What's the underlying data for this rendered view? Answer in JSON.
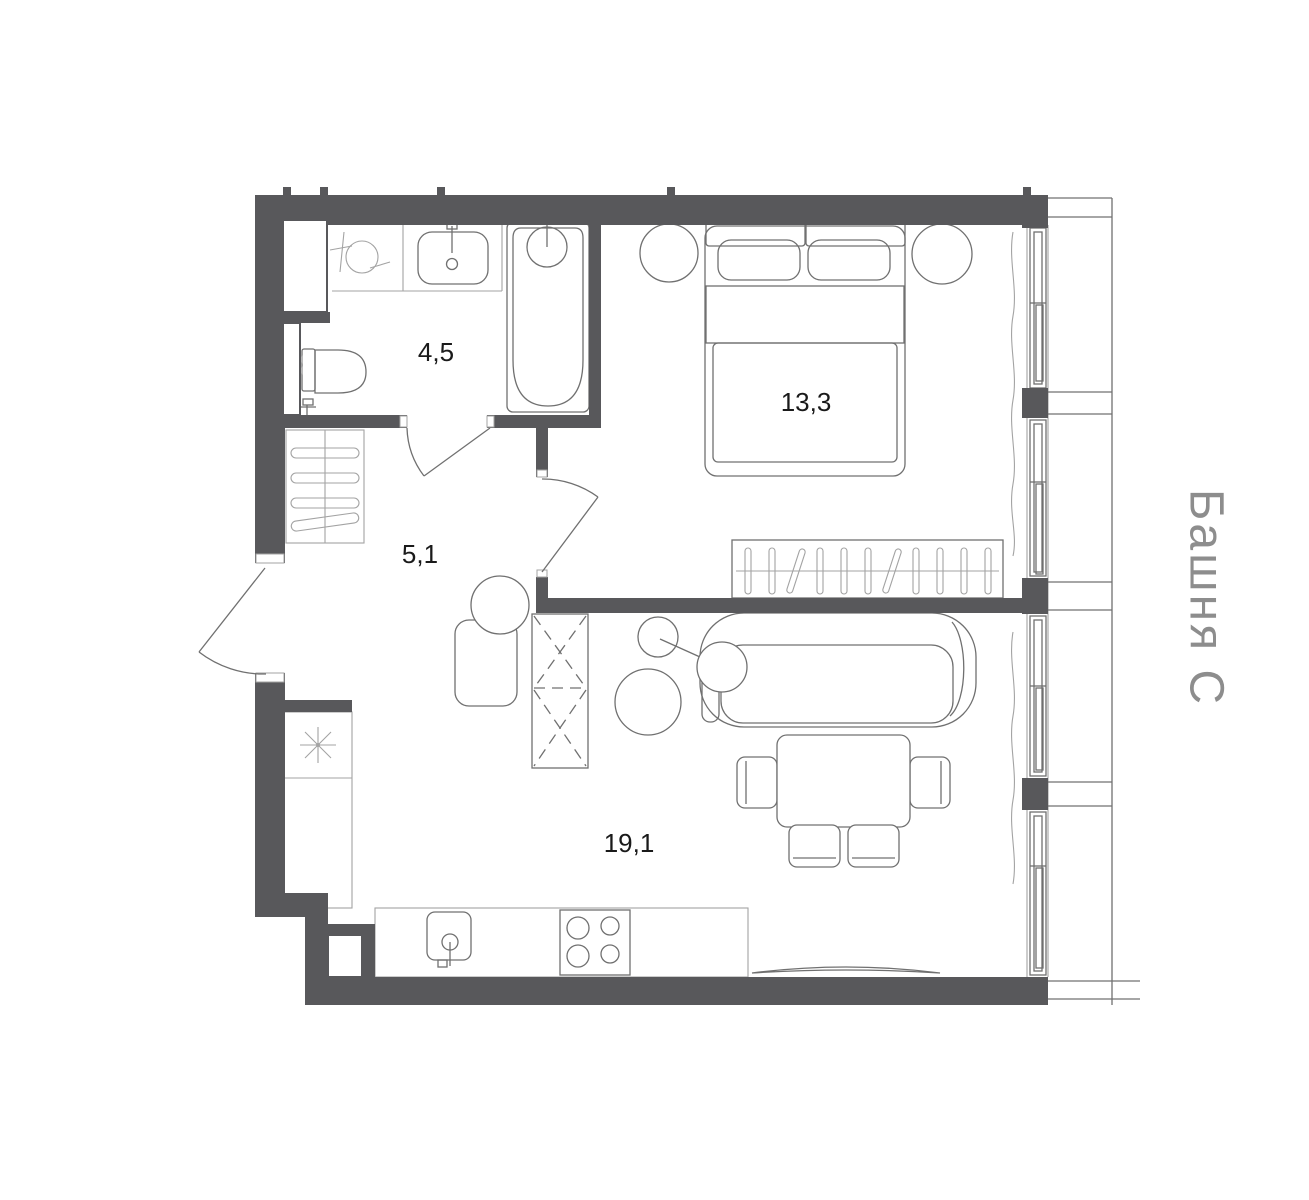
{
  "floorplan": {
    "tower_label": "Башня С",
    "rooms": [
      {
        "name": "bathroom",
        "area_label": "4,5"
      },
      {
        "name": "hallway",
        "area_label": "5,1"
      },
      {
        "name": "bedroom",
        "area_label": "13,3"
      },
      {
        "name": "living-kitchen",
        "area_label": "19,1"
      }
    ],
    "colors": {
      "wall": "#58585b",
      "furniture_stroke": "#707070",
      "light_stroke": "#a3a3a3",
      "label": "#1a1a1a",
      "tower": "#8d8d8d",
      "background": "#ffffff"
    }
  }
}
